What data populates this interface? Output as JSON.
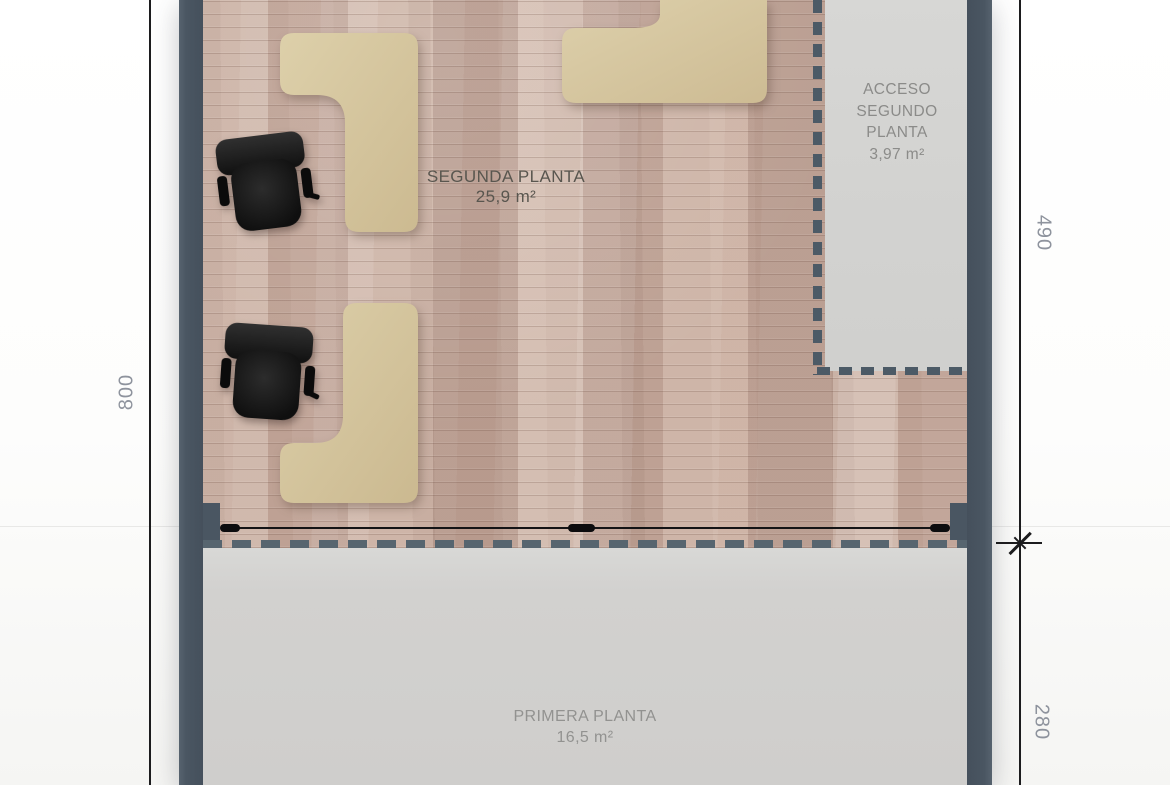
{
  "canvas": {
    "width": 1170,
    "height": 785
  },
  "rooms": {
    "segunda": {
      "name": "SEGUNDA PLANTA",
      "area": "25,9 m²"
    },
    "acceso": {
      "name": "ACCESO\nSEGUNDO\nPLANTA",
      "area": "3,97 m²"
    },
    "primera": {
      "name": "PRIMERA PLANTA",
      "area": "16,5 m²"
    }
  },
  "dimensions": {
    "left": "800",
    "right_upper": "490",
    "right_lower": "280"
  },
  "furniture": {
    "l_shaped_desks": 3,
    "office_chairs": 2
  },
  "colors": {
    "wall": "#4a5662",
    "dashed_partition": "#4c5a66",
    "wood_floor": "#c6ac9f",
    "concrete_floor": "#d2d1cf",
    "desk": "#d6c5a0",
    "chair": "#161616",
    "dimension_text": "#8e939d",
    "room_text_dark": "#59564f",
    "room_text_gray": "#8b8b89",
    "line": "#1c1c1e"
  }
}
